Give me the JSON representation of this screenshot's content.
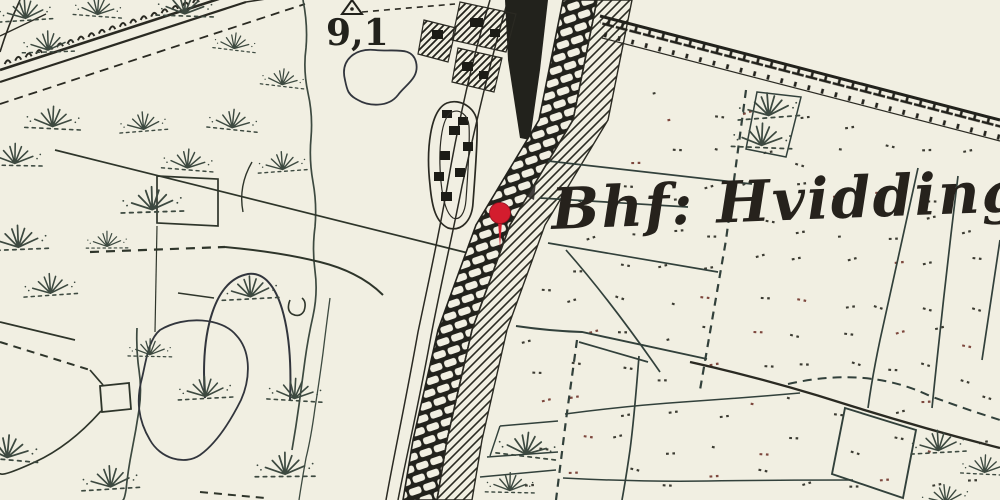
{
  "map": {
    "station_label": "Bhf: Hvidding",
    "elevation_label": "9,1",
    "pin": {
      "title": "Bhf Hvidding",
      "color": "#d31d2e",
      "x": 500,
      "y": 213
    },
    "colors": {
      "paper": "#f1efe2",
      "ink": "#2b2a24",
      "rail_ink": "#23211c",
      "green_ink": "#3c4a40",
      "dot_red": "#7d463c",
      "pin_red": "#d31d2e"
    },
    "symbols": {
      "trig_point": "triangle-with-dot",
      "grass": "marsh-grass-tuft",
      "moor": "dot-pair-texture",
      "railway": "brick-band-track"
    }
  }
}
